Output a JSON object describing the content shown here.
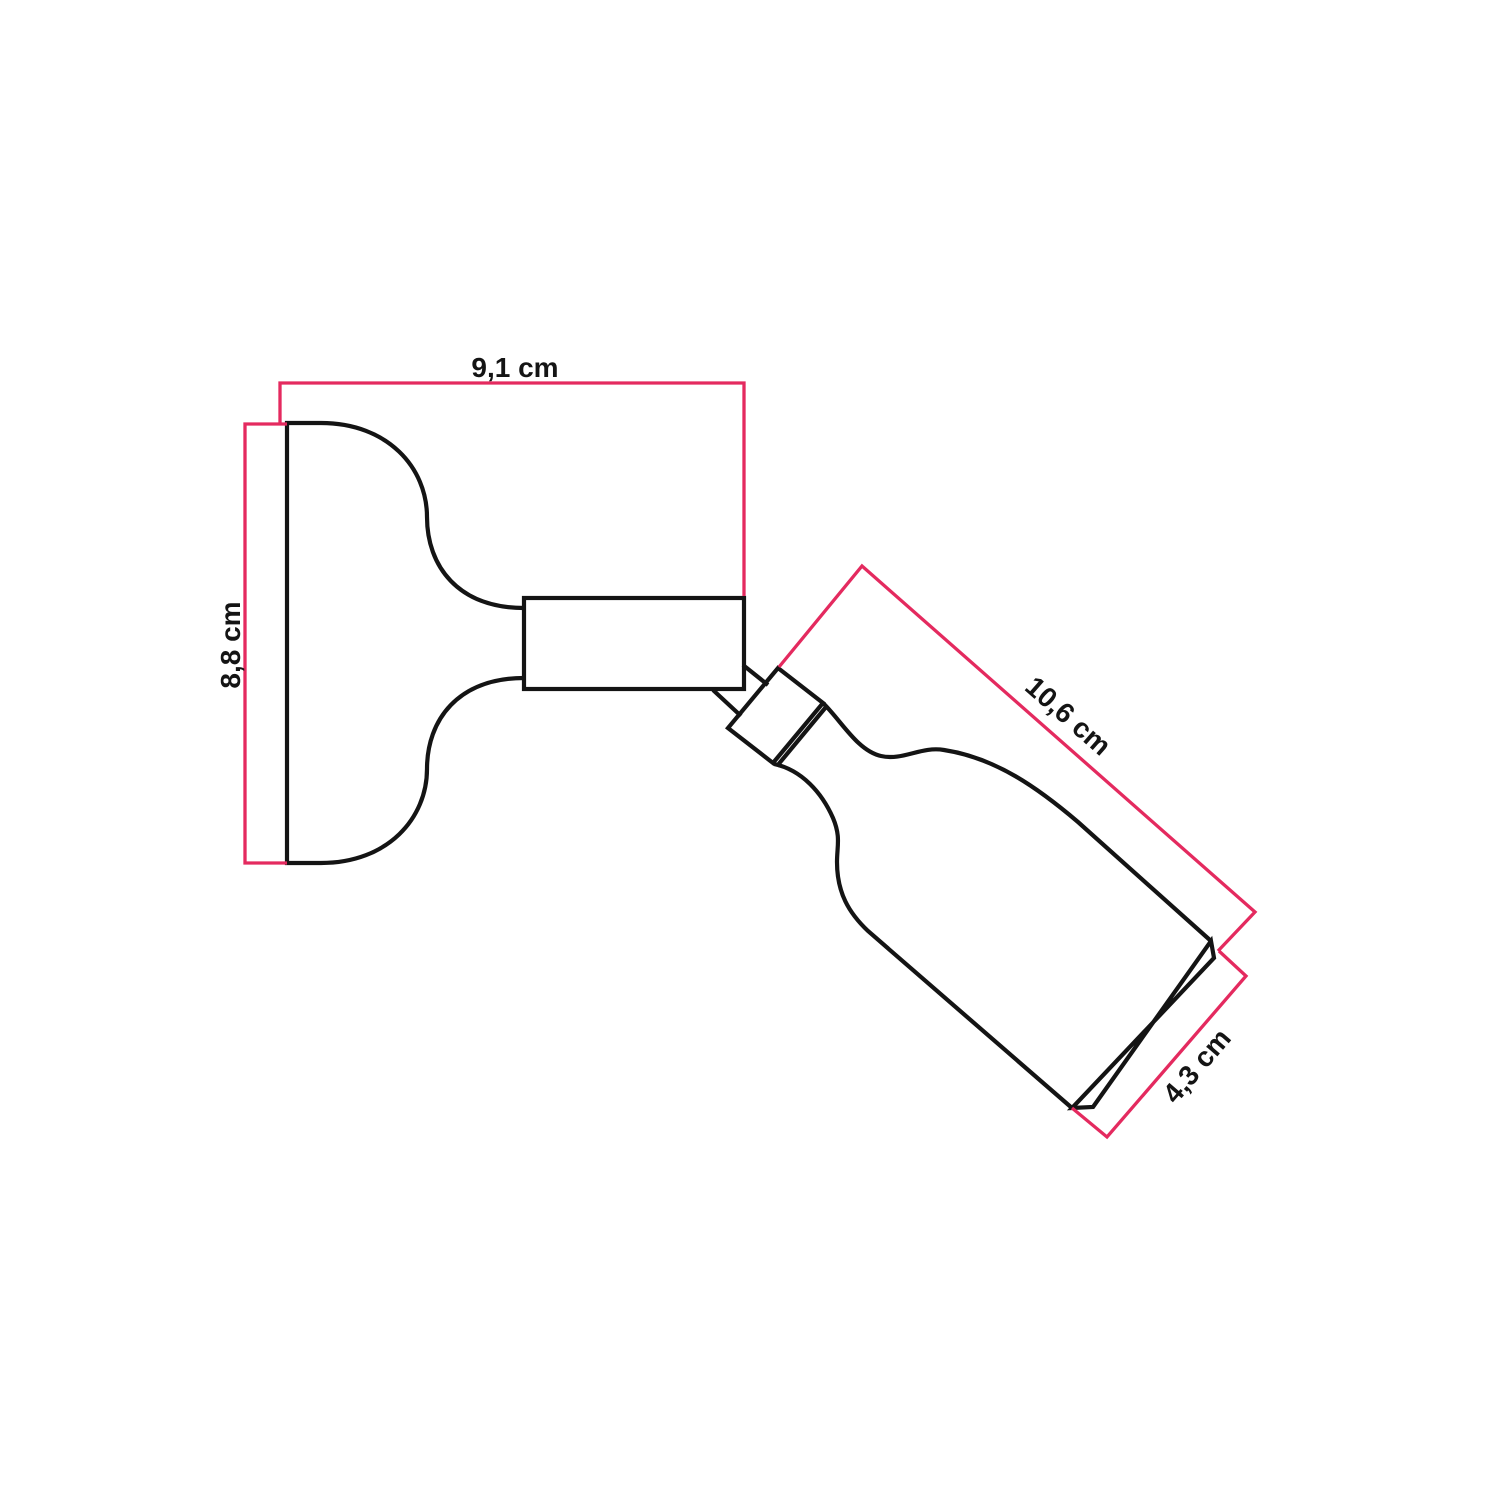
{
  "drawing": {
    "unit": "cm",
    "labels": {
      "width": "9,1 cm",
      "height": "8,8 cm",
      "length": "10,6 cm",
      "diameter": "4,3 cm"
    },
    "values": {
      "width": 9.1,
      "height": 8.8,
      "length": 10.6,
      "diameter": 4.3
    },
    "colors": {
      "dimension_line": "#e42a5f",
      "outline": "#141414",
      "background": "#ffffff"
    }
  }
}
